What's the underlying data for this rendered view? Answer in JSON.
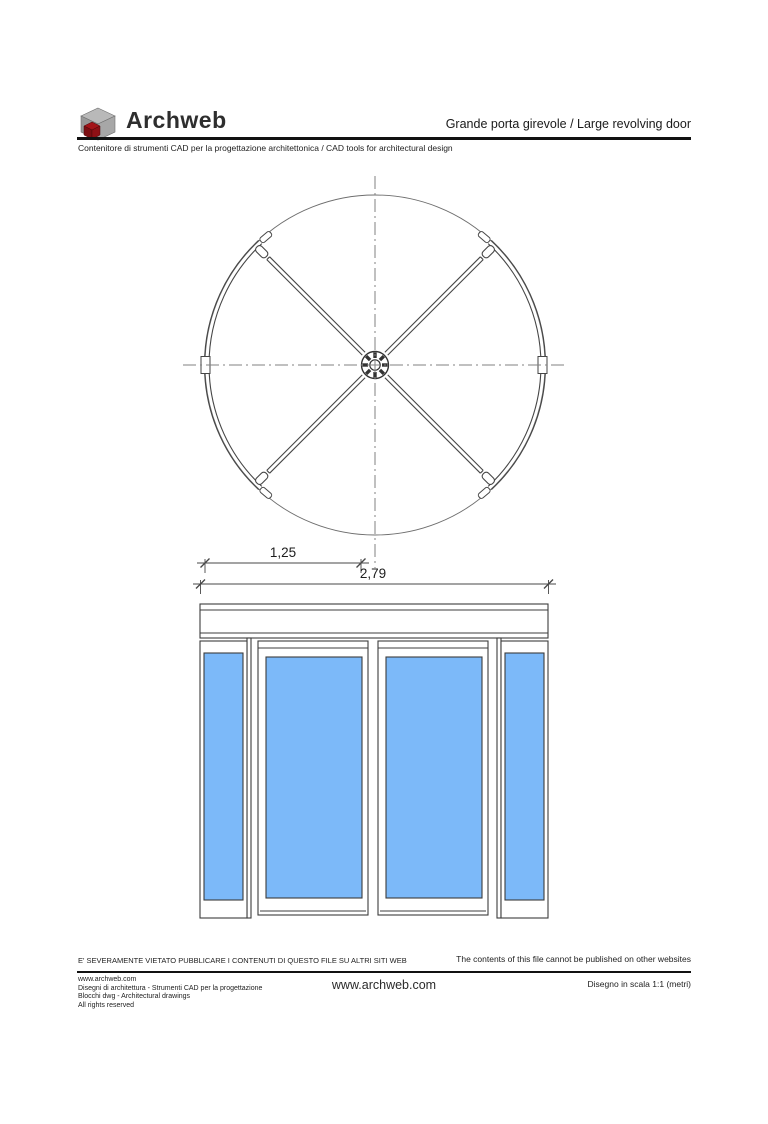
{
  "header": {
    "brand": "Archweb",
    "brand_icon": "archweb-cube-logo",
    "title": "Grande porta girevole  /  Large revolving door",
    "subtitle": "Contenitore di strumenti CAD per la progettazione architettonica  /  CAD tools for architectural design"
  },
  "drawing": {
    "dim_leaf": "1,25",
    "dim_total": "2,79",
    "glass_color": "#7cb9f9",
    "line_color": "#3c3c3c",
    "centerline_color": "#828282"
  },
  "footer": {
    "notice_it": "E' SEVERAMENTE VIETATO PUBBLICARE I CONTENUTI DI QUESTO FILE SU ALTRI SITI WEB",
    "notice_en": "The contents of this file cannot be published on other websites",
    "credits": [
      "www.archweb.com",
      "Disegni di architettura - Strumenti CAD  per la progettazione",
      "Blocchi dwg - Architectural drawings",
      "All rights reserved"
    ],
    "site": "www.archweb.com",
    "scale": "Disegno in scala 1:1 (metri)"
  }
}
